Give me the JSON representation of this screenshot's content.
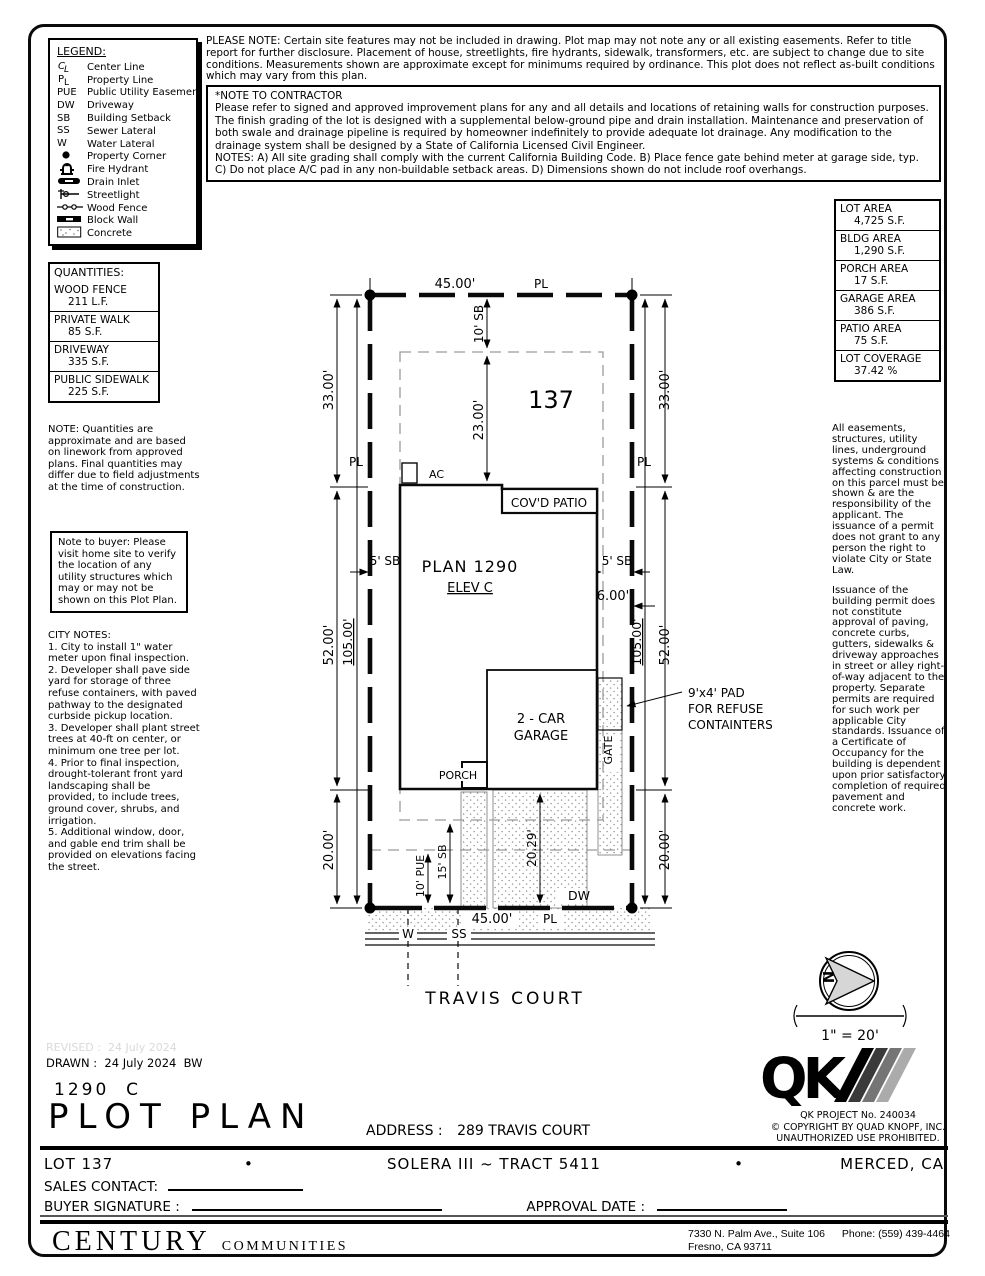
{
  "header": {
    "please_note": "PLEASE NOTE:  Certain site features may not be included in drawing.  Plot map may not note any or all existing easements. Refer to title report for further disclosure.  Placement of house, streetlights, fire hydrants, sidewalk, transformers, etc. are subject to change due to site conditions.  Measurements shown are approximate except for minimums required by ordinance.  This plot does not reflect as-built conditions which may vary from this plan.",
    "contractor_title": "*NOTE TO CONTRACTOR",
    "contractor_lines": [
      "Please refer to signed and approved improvement plans for any and all details and locations of retaining walls for construction purposes.",
      "The finish grading of the lot is designed with a supplemental below-ground pipe and drain installation.  Maintenance and preservation of both swale and drainage pipeline is required by homeowner indefinitely to provide adequate lot drainage.  Any modification to the drainage system shall be designed by a State of California Licensed Civil Engineer.",
      "NOTES:  A) All site grading shall comply with the current California Building Code.  B) Place fence gate behind meter at garage side, typ.  C) Do not place A/C pad in any non-buildable setback areas.  D) Dimensions shown do not include roof overhangs."
    ]
  },
  "legend": {
    "title": "LEGEND:",
    "items": [
      {
        "icon": "center-line-icon",
        "label": "Center Line"
      },
      {
        "icon": "property-line-icon",
        "label": "Property Line"
      },
      {
        "icon": "abbr",
        "text": "PUE",
        "label": "Public Utility Easement"
      },
      {
        "icon": "abbr",
        "text": "DW",
        "label": "Driveway"
      },
      {
        "icon": "abbr",
        "text": "SB",
        "label": "Building Setback"
      },
      {
        "icon": "abbr",
        "text": "SS",
        "label": "Sewer Lateral"
      },
      {
        "icon": "abbr",
        "text": "W",
        "label": "Water Lateral"
      },
      {
        "icon": "property-corner-icon",
        "label": "Property Corner"
      },
      {
        "icon": "fire-hydrant-icon",
        "label": "Fire Hydrant"
      },
      {
        "icon": "drain-inlet-icon",
        "label": "Drain Inlet"
      },
      {
        "icon": "streetlight-icon",
        "label": "Streetlight"
      },
      {
        "icon": "wood-fence-icon",
        "label": "Wood Fence"
      },
      {
        "icon": "block-wall-icon",
        "label": "Block Wall"
      },
      {
        "icon": "concrete-icon",
        "label": "Concrete"
      }
    ]
  },
  "quantities": {
    "title": "QUANTITIES:",
    "rows": [
      {
        "name": "WOOD FENCE",
        "value": "211 L.F."
      },
      {
        "name": "PRIVATE WALK",
        "value": "85 S.F."
      },
      {
        "name": "DRIVEWAY",
        "value": "335 S.F."
      },
      {
        "name": "PUBLIC SIDEWALK",
        "value": "225 S.F."
      }
    ],
    "note": "NOTE: Quantities are approximate and are based on linework from approved plans.  Final quantities may differ due to field adjustments at the time of construction."
  },
  "buyer_note": "Note to buyer: Please visit home site to verify the location of any utility structures which may or may not be shown on this Plot Plan.",
  "city_notes": {
    "title": "CITY NOTES:",
    "lines": [
      "1. City to install 1\" water meter upon final inspection.",
      "2. Developer shall pave side yard for storage of three refuse containers, with paved pathway to the designated curbside pickup location.",
      "3. Developer shall plant street trees at 40-ft on center, or minimum one tree per lot.",
      "4. Prior to final inspection, drought-tolerant front yard landscaping shall be provided, to include trees, ground cover, shrubs, and irrigation.",
      "5. Additional window, door, and gable end trim shall be provided on elevations facing the street."
    ]
  },
  "areas": {
    "rows": [
      {
        "name": "LOT AREA",
        "value": "4,725 S.F."
      },
      {
        "name": "BLDG AREA",
        "value": "1,290 S.F."
      },
      {
        "name": "PORCH AREA",
        "value": "17 S.F."
      },
      {
        "name": "GARAGE AREA",
        "value": "386 S.F."
      },
      {
        "name": "PATIO AREA",
        "value": "75 S.F."
      },
      {
        "name": "LOT COVERAGE",
        "value": "37.42 %"
      }
    ]
  },
  "permit_notes": [
    "All easements, structures, utility lines, underground systems & conditions affecting construction on this parcel must be shown & are the responsibility of the applicant. The issuance of a permit does not grant to any person the right to violate City or State Law.",
    "Issuance of the building permit does not constitute approval of paving, concrete curbs, gutters, sidewalks & driveway approaches in street or alley right-of-way adjacent to the property. Separate permits are required for such work per applicable City standards. Issuance of a Certificate of Occupancy for the building is dependent upon prior satisfactory completion of required pavement and concrete work."
  ],
  "plot": {
    "lot_number": "137",
    "plan": "PLAN 1290",
    "elev": "ELEV C",
    "ac": "AC",
    "covd_patio": "COV'D PATIO",
    "garage_line1": "2 - CAR",
    "garage_line2": "GARAGE",
    "porch": "PORCH",
    "gate": "GATE",
    "dw": "DW",
    "refuse_line1": "9'x4' PAD",
    "refuse_line2": "FOR REFUSE",
    "refuse_line3": "CONTAINTERS",
    "street": "TRAVIS COURT",
    "north": "N",
    "scale": "1\" = 20'",
    "dims": {
      "front_width": "45.00'",
      "pl": "PL",
      "front_sb": "10' SB",
      "front_depth": "23.00'",
      "side_front": "33.00'",
      "side_mid": "52.00'",
      "side_total": "105.00'",
      "side_rear": "20.00'",
      "side_sb": "5' SB",
      "garage_side": "6.00'",
      "drive_len": "20.29'",
      "rear_sb": "15' SB",
      "pue": "10' PUE",
      "water": "W",
      "sewer": "SS"
    }
  },
  "qk": {
    "logo": "QK",
    "project": "QK PROJECT No. 240034",
    "copyright": "©  COPYRIGHT BY QUAD KNOPF, INC.",
    "prohibited": "UNAUTHORIZED USE PROHIBITED."
  },
  "titleblock": {
    "revised": "REVISED :  24 July 2024",
    "drawn": "DRAWN :  24 July 2024  BW",
    "model": "1290  C",
    "title": "PLOT PLAN",
    "address_label": "ADDRESS :",
    "address": "289 TRAVIS COURT",
    "lot": "LOT 137",
    "bullet": "•",
    "tract": "SOLERA III ~ TRACT 5411",
    "city": "MERCED, CA",
    "sales_contact": "SALES CONTACT:",
    "buyer_signature": "BUYER SIGNATURE :",
    "approval_date": "APPROVAL DATE :"
  },
  "footer": {
    "brand": "CENTURY",
    "brand2": "COMMUNITIES",
    "address_line1a": "7330 N. Palm Ave., Suite 106",
    "phone": "Phone:  (559) 439-4464",
    "address_line2": "Fresno, CA  93711"
  },
  "colors": {
    "ink": "#0a0a0a",
    "setback_gray": "#9a9a9a",
    "hatch_gray": "#8f8f8f",
    "faint_gray": "#d9d9d9"
  }
}
